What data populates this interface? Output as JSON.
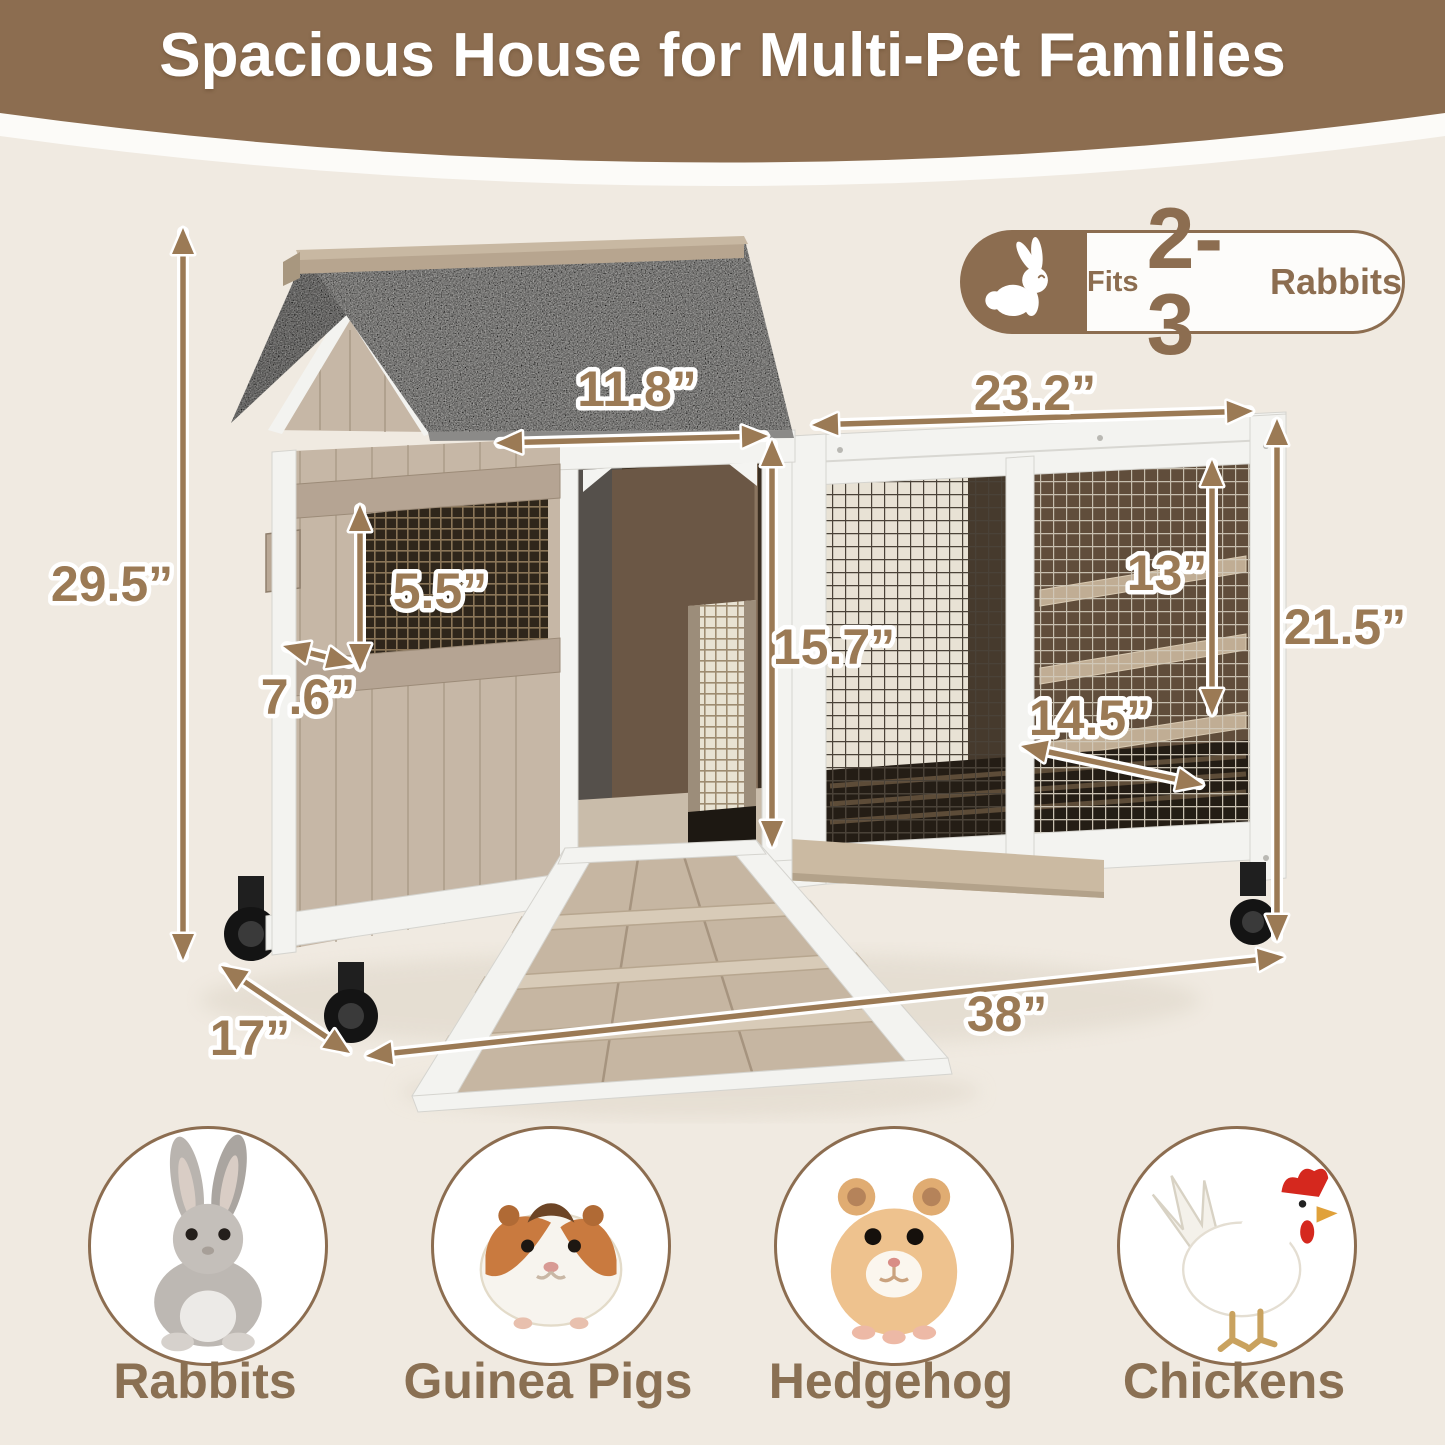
{
  "header": {
    "title": "Spacious House for Multi-Pet Families",
    "band_color": "#8c6d50",
    "text_color": "#ffffff"
  },
  "capacity_badge": {
    "prefix": "Fits",
    "count": "2-3",
    "suffix": "Rabbits",
    "icon": "rabbit-icon",
    "color": "#8c6d50"
  },
  "dimensions": {
    "color": "#9b7a55",
    "outline_color": "#ffffff",
    "items": [
      {
        "id": "overall-height",
        "label": "29.5”",
        "x1": 183,
        "y1": 228,
        "x2": 183,
        "y2": 960,
        "lx": 112,
        "ly": 601
      },
      {
        "id": "hutch-depth",
        "label": "17”",
        "x1": 221,
        "y1": 966,
        "x2": 350,
        "y2": 1053,
        "lx": 250,
        "ly": 1055
      },
      {
        "id": "overall-width",
        "label": "38”",
        "x1": 366,
        "y1": 1056,
        "x2": 1284,
        "y2": 957,
        "lx": 1007,
        "ly": 1031
      },
      {
        "id": "door-width",
        "label": "11.8”",
        "x1": 496,
        "y1": 443,
        "x2": 768,
        "y2": 436,
        "lx": 637,
        "ly": 406
      },
      {
        "id": "run-width",
        "label": "23.2”",
        "x1": 812,
        "y1": 425,
        "x2": 1253,
        "y2": 411,
        "lx": 1035,
        "ly": 410
      },
      {
        "id": "window-height",
        "label": "5.5”",
        "x1": 360,
        "y1": 505,
        "x2": 360,
        "y2": 670,
        "lx": 440,
        "ly": 608
      },
      {
        "id": "window-width",
        "label": "7.6”",
        "x1": 283,
        "y1": 646,
        "x2": 353,
        "y2": 664,
        "lx": 308,
        "ly": 714
      },
      {
        "id": "door-height",
        "label": "15.7”",
        "x1": 772,
        "y1": 440,
        "x2": 772,
        "y2": 847,
        "lx": 834,
        "ly": 664
      },
      {
        "id": "shelf-height",
        "label": "13”",
        "x1": 1212,
        "y1": 460,
        "x2": 1212,
        "y2": 715,
        "lx": 1167,
        "ly": 590
      },
      {
        "id": "run-depth",
        "label": "14.5”",
        "x1": 1021,
        "y1": 746,
        "x2": 1203,
        "y2": 785,
        "lx": 1090,
        "ly": 735
      },
      {
        "id": "run-height",
        "label": "21.5”",
        "x1": 1277,
        "y1": 419,
        "x2": 1277,
        "y2": 941,
        "lx": 1345,
        "ly": 644
      }
    ]
  },
  "animals": {
    "label_color": "#8a7053",
    "items": [
      {
        "label": "Rabbits"
      },
      {
        "label": "Guinea Pigs"
      },
      {
        "label": "Hedgehog"
      },
      {
        "label": "Chickens"
      }
    ]
  },
  "colors": {
    "background": "#f0eae1",
    "roof_gray": "#a5a4a2",
    "wood_beige": "#c6b7a6",
    "trim_white": "#f3f3f0"
  }
}
